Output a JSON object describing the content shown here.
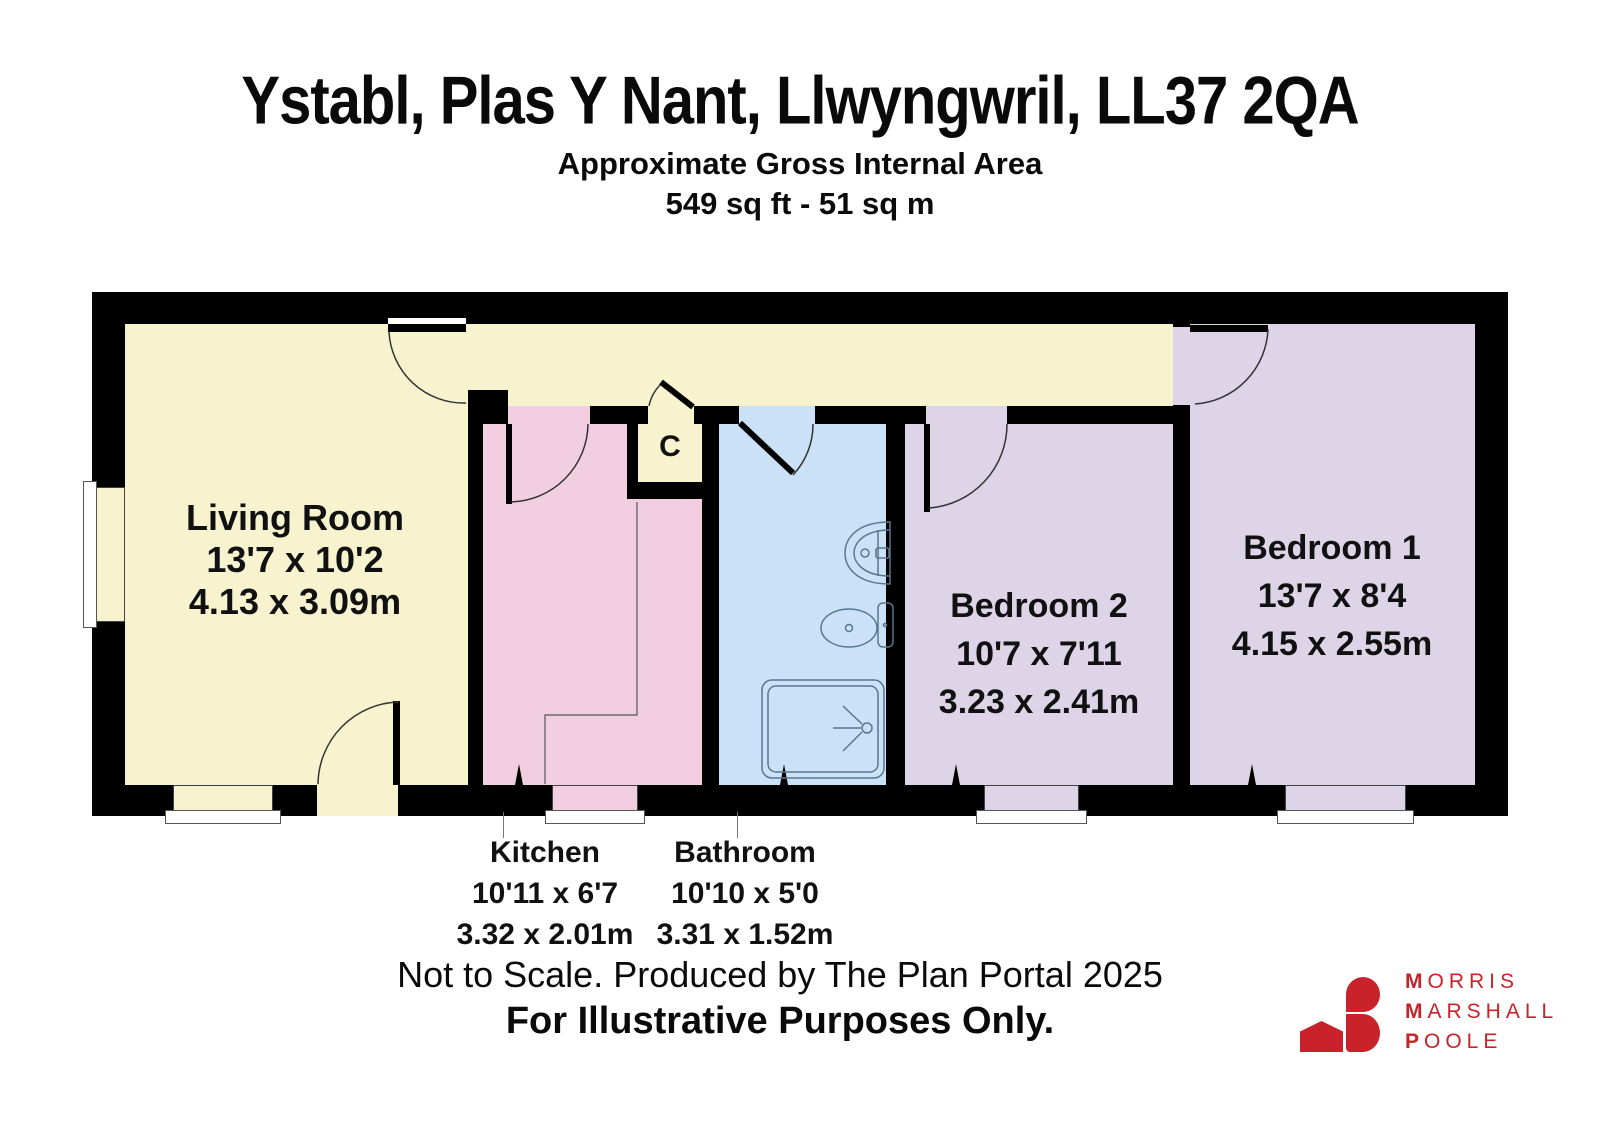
{
  "header": {
    "title": "Ystabl, Plas Y Nant, Llwyngwril, LL37 2QA",
    "subtitle": "Approximate Gross Internal Area",
    "area": "549 sq ft - 51 sq m"
  },
  "rooms": {
    "living": {
      "name": "Living Room",
      "imperial": "13'7 x 10'2",
      "metric": "4.13 x 3.09m"
    },
    "kitchen": {
      "name": "Kitchen",
      "imperial": "10'11 x 6'7",
      "metric": "3.32 x 2.01m"
    },
    "bathroom": {
      "name": "Bathroom",
      "imperial": "10'10 x 5'0",
      "metric": "3.31 x 1.52m"
    },
    "bedroom2": {
      "name": "Bedroom 2",
      "imperial": "10'7 x 7'11",
      "metric": "3.23 x 2.41m"
    },
    "bedroom1": {
      "name": "Bedroom 1",
      "imperial": "13'7 x 8'4",
      "metric": "4.15 x 2.55m"
    },
    "closet": {
      "label": "C"
    }
  },
  "footer": {
    "line1": "Not to Scale. Produced by The Plan Portal 2025",
    "line2": "For Illustrative Purposes Only."
  },
  "logo": {
    "lines": [
      {
        "initial": "M",
        "rest": "ORRIS"
      },
      {
        "initial": "M",
        "rest": "ARSHALL"
      },
      {
        "initial": "P",
        "rest": "OOLE"
      }
    ],
    "color": "#c8232b"
  },
  "colors": {
    "wall": "#000000",
    "living_hall_closet": "#f8f3cf",
    "kitchen": "#f2cfe0",
    "bathroom": "#cbe1f7",
    "bedrooms": "#ddd4e8",
    "fixture_line": "#5a768f"
  },
  "icons": [
    "sink-icon",
    "toilet-icon",
    "shower-icon",
    "door-arc",
    "house-icon"
  ]
}
